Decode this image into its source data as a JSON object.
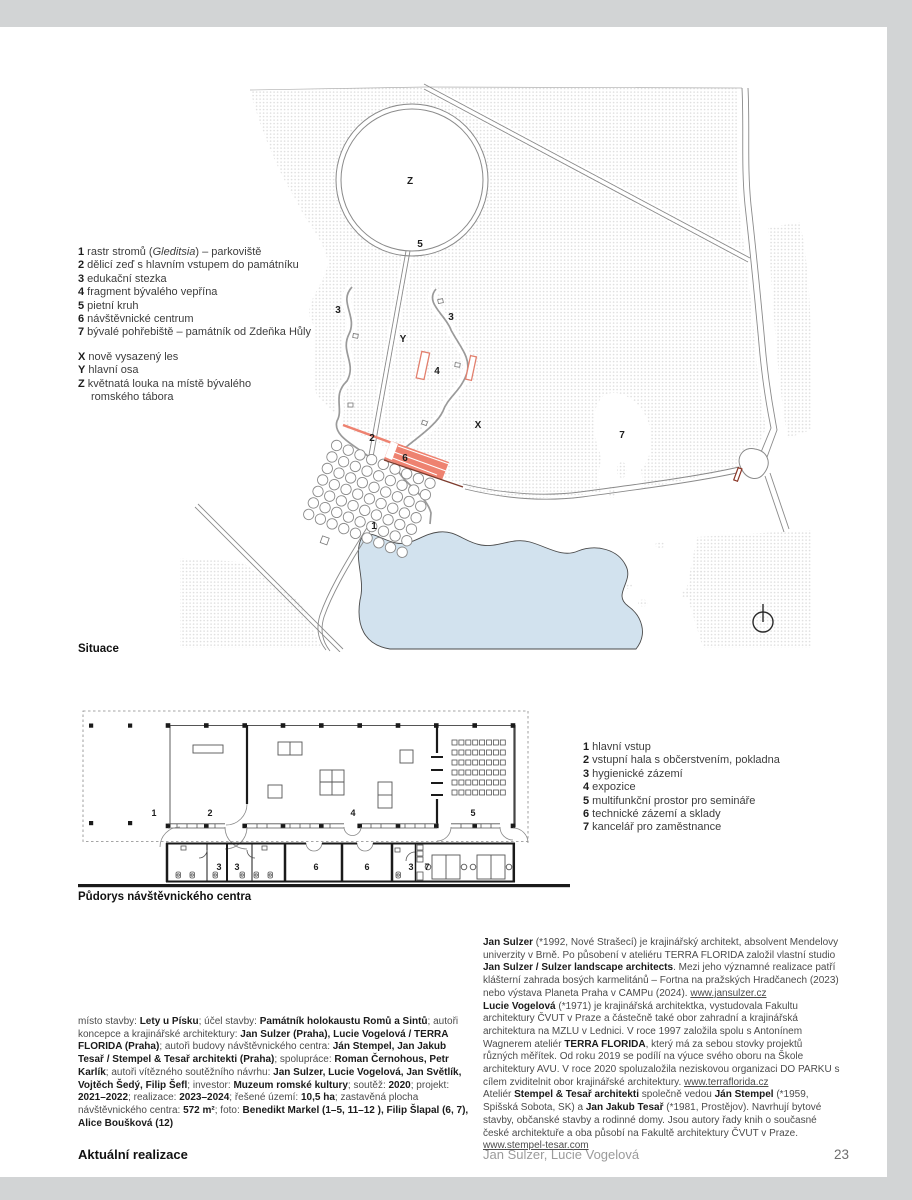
{
  "page": {
    "background": "#d2d4d5",
    "paper": "#ffffff",
    "footer": {
      "section": "Aktuální realizace",
      "authors": "Jan Sulzer, Lucie Vogelová",
      "page_number": "23"
    }
  },
  "colors": {
    "accent_salmon": "#ee8270",
    "wall_dark_red": "#7d3b2d",
    "water_blue": "#d2e2ee",
    "forest_dot": "#e0e0e0"
  },
  "site_plan": {
    "caption": "Situace",
    "legend_numbered": [
      [
        {
          "t": "1",
          "b": 1
        },
        {
          "t": " rastr stromů ("
        },
        {
          "t": "Gleditsia",
          "i": 1
        },
        {
          "t": ") – parkoviště"
        }
      ],
      [
        {
          "t": "2",
          "b": 1
        },
        {
          "t": " dělicí zeď s hlavním vstupem do památníku"
        }
      ],
      [
        {
          "t": "3",
          "b": 1
        },
        {
          "t": " edukační stezka"
        }
      ],
      [
        {
          "t": "4",
          "b": 1
        },
        {
          "t": " fragment bývalého vepřína"
        }
      ],
      [
        {
          "t": "5",
          "b": 1
        },
        {
          "t": " pietní kruh"
        }
      ],
      [
        {
          "t": "6",
          "b": 1
        },
        {
          "t": " návštěvnické centrum"
        }
      ],
      [
        {
          "t": "7",
          "b": 1
        },
        {
          "t": " bývalé pohřebiště – památník od Zdeňka Hůly"
        }
      ]
    ],
    "legend_letters": [
      [
        {
          "t": "X",
          "b": 1
        },
        {
          "t": " nově vysazený les"
        }
      ],
      [
        {
          "t": "Y",
          "b": 1
        },
        {
          "t": " hlavní osa"
        }
      ],
      [
        {
          "t": "Z",
          "b": 1
        },
        {
          "t": " květnatá louka na místě bývalého romského tábora"
        }
      ]
    ],
    "map_labels": [
      {
        "t": "Z",
        "x": 410,
        "y": 184
      },
      {
        "t": "5",
        "x": 420,
        "y": 247
      },
      {
        "t": "3",
        "x": 338,
        "y": 313
      },
      {
        "t": "Y",
        "x": 403,
        "y": 342
      },
      {
        "t": "3",
        "x": 451,
        "y": 320
      },
      {
        "t": "4",
        "x": 437,
        "y": 374
      },
      {
        "t": "X",
        "x": 478,
        "y": 428
      },
      {
        "t": "2",
        "x": 372,
        "y": 441
      },
      {
        "t": "6",
        "x": 405,
        "y": 461
      },
      {
        "t": "1",
        "x": 374,
        "y": 529
      },
      {
        "t": "7",
        "x": 622,
        "y": 438
      }
    ]
  },
  "floor_plan": {
    "caption": "Půdorys návštěvnického centra",
    "legend": [
      [
        {
          "t": "1",
          "b": 1
        },
        {
          "t": " hlavní vstup"
        }
      ],
      [
        {
          "t": "2",
          "b": 1
        },
        {
          "t": " vstupní hala s občerstvením, pokladna"
        }
      ],
      [
        {
          "t": "3",
          "b": 1
        },
        {
          "t": " hygienické zázemí"
        }
      ],
      [
        {
          "t": "4",
          "b": 1
        },
        {
          "t": " expozice"
        }
      ],
      [
        {
          "t": "5",
          "b": 1
        },
        {
          "t": " multifunkční prostor pro semináře"
        }
      ],
      [
        {
          "t": "6",
          "b": 1
        },
        {
          "t": " technické zázemí a sklady"
        }
      ],
      [
        {
          "t": "7",
          "b": 1
        },
        {
          "t": " kancelář pro zaměstnance"
        }
      ]
    ],
    "room_labels": [
      {
        "t": "1",
        "x": 154,
        "y": 816
      },
      {
        "t": "2",
        "x": 210,
        "y": 816
      },
      {
        "t": "4",
        "x": 353,
        "y": 816
      },
      {
        "t": "5",
        "x": 473,
        "y": 816
      },
      {
        "t": "3",
        "x": 219,
        "y": 870
      },
      {
        "t": "3",
        "x": 237,
        "y": 870
      },
      {
        "t": "6",
        "x": 316,
        "y": 870
      },
      {
        "t": "6",
        "x": 367,
        "y": 870
      },
      {
        "t": "3",
        "x": 411,
        "y": 870
      },
      {
        "t": "7",
        "x": 427,
        "y": 870
      }
    ]
  },
  "project_info": {
    "segments": [
      {
        "t": "místo stavby: "
      },
      {
        "t": "Lety u Písku",
        "b": 1
      },
      {
        "t": "; účel stavby: "
      },
      {
        "t": "Památník holokaustu Romů a Sintů",
        "b": 1
      },
      {
        "t": "; autoři koncepce a krajinářské architektury: "
      },
      {
        "t": "Jan Sulzer (Praha), Lucie Vogelová / TERRA FLORIDA (Praha)",
        "b": 1
      },
      {
        "t": "; autoři budovy návštěvnického centra: "
      },
      {
        "t": "Ján Stempel, Jan Jakub Tesař / Stempel & Tesař architekti (Praha)",
        "b": 1
      },
      {
        "t": "; spolupráce: "
      },
      {
        "t": "Roman Černohous, Petr Karlík",
        "b": 1
      },
      {
        "t": "; autoři vítězného soutěžního návrhu: "
      },
      {
        "t": "Jan Sulzer, Lucie Vogelová, Jan Světlík, Vojtěch Šedý, Filip Šefl",
        "b": 1
      },
      {
        "t": "; investor: "
      },
      {
        "t": "Muzeum romské kultury",
        "b": 1
      },
      {
        "t": "; soutěž: "
      },
      {
        "t": "2020",
        "b": 1
      },
      {
        "t": "; projekt: "
      },
      {
        "t": "2021–2022",
        "b": 1
      },
      {
        "t": "; realizace: "
      },
      {
        "t": "2023–2024",
        "b": 1
      },
      {
        "t": "; řešené území: "
      },
      {
        "t": "10,5 ha",
        "b": 1
      },
      {
        "t": "; zastavěná plocha návštěvnického centra: "
      },
      {
        "t": "572 m²",
        "b": 1
      },
      {
        "t": "; foto: "
      },
      {
        "t": "Benedikt Markel (1–5, 11–12 ), Filip Šlapal (6, 7), Alice Boušková (12)",
        "b": 1
      }
    ]
  },
  "bios": {
    "p1": [
      {
        "t": "Jan Sulzer",
        "b": 1
      },
      {
        "t": " (*1992, Nové Strašecí) je krajinářský architekt, absolvent Mendelovy univerzity v Brně. Po působení v ateliéru TERRA FLORIDA založil vlastní studio "
      },
      {
        "t": "Jan Sulzer / Sulzer landscape architects",
        "b": 1
      },
      {
        "t": ". Mezi jeho významné realizace patří klášterní zahrada bosých karmelitánů – Fortna na pražských Hradčanech (2023) nebo výstava Planeta Praha v CAMPu (2024). "
      },
      {
        "t": "www.jansulzer.cz",
        "u": 1,
        "link": 1
      }
    ],
    "p2": [
      {
        "t": "Lucie Vogelová",
        "b": 1
      },
      {
        "t": " (*1971) je krajinářská architektka, vystudovala Fakultu architektury ČVUT v Praze a částečně také obor zahradní a krajinářská architektura na MZLU v Lednici. V roce 1997 založila spolu s Antonínem Wagnerem ateliér "
      },
      {
        "t": "TERRA FLORIDA",
        "b": 1
      },
      {
        "t": ", který má za sebou stovky projektů různých měřítek. Od roku 2019 se podílí na výuce svého oboru na Škole architektury AVU. V roce 2020 spoluzaložila neziskovou organizaci DO PARKU s cílem zviditelnit obor krajinářské architektury. "
      },
      {
        "t": "www.terraflorida.cz",
        "u": 1,
        "link": 1
      }
    ],
    "p3": [
      {
        "t": "Ateliér "
      },
      {
        "t": "Stempel & Tesař architekti",
        "b": 1
      },
      {
        "t": " společně vedou "
      },
      {
        "t": "Ján Stempel",
        "b": 1
      },
      {
        "t": " (*1959, Spišská Sobota, SK) a "
      },
      {
        "t": "Jan Jakub Tesař",
        "b": 1
      },
      {
        "t": " (*1981, Prostějov). Navrhují bytové stavby, občanské stavby a rodinné domy. Jsou autory řady knih o současné české architektuře a oba působí na Fakultě architektury ČVUT v Praze. "
      },
      {
        "t": "www.stempel-tesar.com",
        "u": 1,
        "link": 1
      }
    ]
  }
}
